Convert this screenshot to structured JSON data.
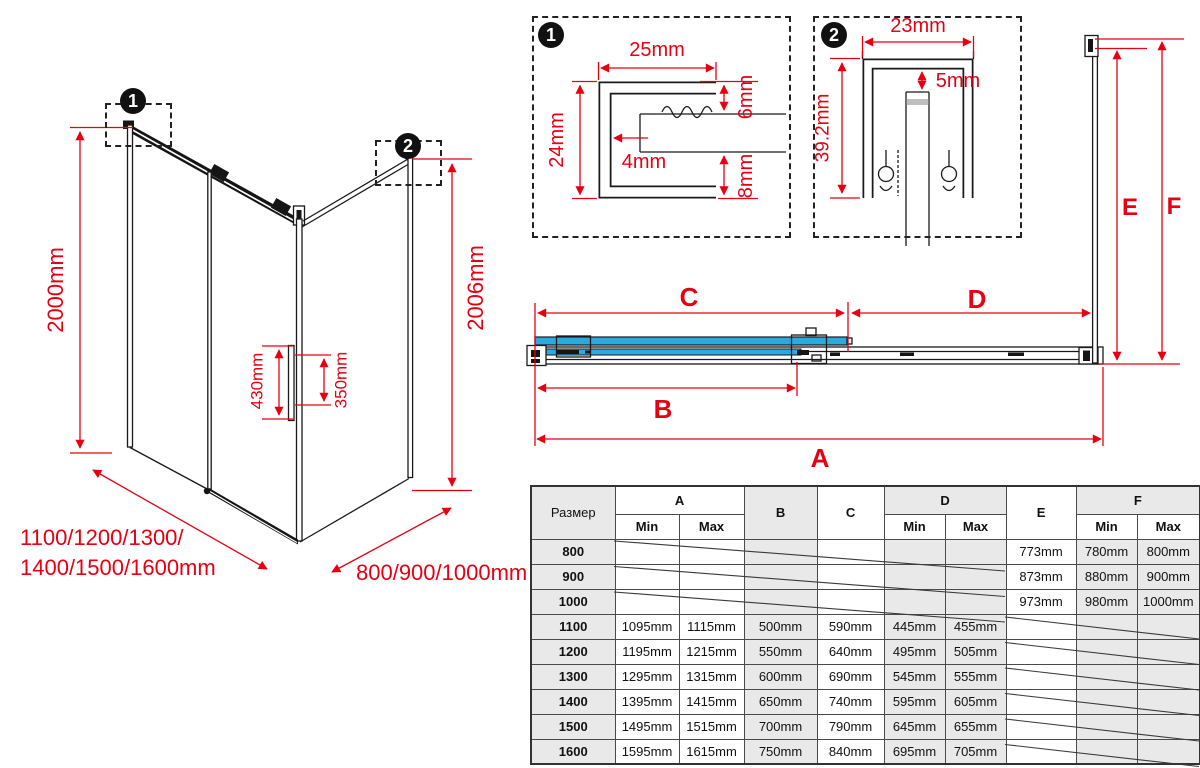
{
  "iso": {
    "callout1": "1",
    "callout2": "2",
    "height_left": "2000mm",
    "height_right": "2006mm",
    "handle_height": "430mm",
    "handle_holes": "350mm",
    "width_line1": "1100/1200/1300/",
    "width_line2": "1400/1500/1600mm",
    "depth": "800/900/1000mm"
  },
  "detail1": {
    "badge": "1",
    "dim_width": "25mm",
    "dim_height": "24mm",
    "dim_web": "4mm",
    "dim_top_gap": "6mm",
    "dim_bottom_gap": "8mm"
  },
  "detail2": {
    "badge": "2",
    "dim_width": "23mm",
    "dim_gap": "5mm",
    "dim_height": "39.2mm"
  },
  "plan": {
    "dim_a": "A",
    "dim_b": "B",
    "dim_c": "C",
    "dim_d": "D",
    "dim_e": "E",
    "dim_f": "F"
  },
  "table": {
    "size_header": "Размер",
    "min": "Min",
    "max": "Max",
    "cols": {
      "a": "A",
      "b": "B",
      "c": "C",
      "d": "D",
      "e": "E",
      "f": "F"
    },
    "rows": [
      {
        "size": "800",
        "a_min": "",
        "a_max": "",
        "b": "",
        "c": "",
        "d_min": "",
        "d_max": "",
        "e": "773mm",
        "f_min": "780mm",
        "f_max": "800mm"
      },
      {
        "size": "900",
        "a_min": "",
        "a_max": "",
        "b": "",
        "c": "",
        "d_min": "",
        "d_max": "",
        "e": "873mm",
        "f_min": "880mm",
        "f_max": "900mm"
      },
      {
        "size": "1000",
        "a_min": "",
        "a_max": "",
        "b": "",
        "c": "",
        "d_min": "",
        "d_max": "",
        "e": "973mm",
        "f_min": "980mm",
        "f_max": "1000mm"
      },
      {
        "size": "1100",
        "a_min": "1095mm",
        "a_max": "1115mm",
        "b": "500mm",
        "c": "590mm",
        "d_min": "445mm",
        "d_max": "455mm",
        "e": "",
        "f_min": "",
        "f_max": ""
      },
      {
        "size": "1200",
        "a_min": "1195mm",
        "a_max": "1215mm",
        "b": "550mm",
        "c": "640mm",
        "d_min": "495mm",
        "d_max": "505mm",
        "e": "",
        "f_min": "",
        "f_max": ""
      },
      {
        "size": "1300",
        "a_min": "1295mm",
        "a_max": "1315mm",
        "b": "600mm",
        "c": "690mm",
        "d_min": "545mm",
        "d_max": "555mm",
        "e": "",
        "f_min": "",
        "f_max": ""
      },
      {
        "size": "1400",
        "a_min": "1395mm",
        "a_max": "1415mm",
        "b": "650mm",
        "c": "740mm",
        "d_min": "595mm",
        "d_max": "605mm",
        "e": "",
        "f_min": "",
        "f_max": ""
      },
      {
        "size": "1500",
        "a_min": "1495mm",
        "a_max": "1515mm",
        "b": "700mm",
        "c": "790mm",
        "d_min": "645mm",
        "d_max": "655mm",
        "e": "",
        "f_min": "",
        "f_max": ""
      },
      {
        "size": "1600",
        "a_min": "1595mm",
        "a_max": "1615mm",
        "b": "750mm",
        "c": "840mm",
        "d_min": "695mm",
        "d_max": "705mm",
        "e": "",
        "f_min": "",
        "f_max": ""
      }
    ]
  },
  "colors": {
    "accent_red": "#e60012",
    "glass_blue": "#29abe2",
    "line_black": "#1a1a1a"
  }
}
